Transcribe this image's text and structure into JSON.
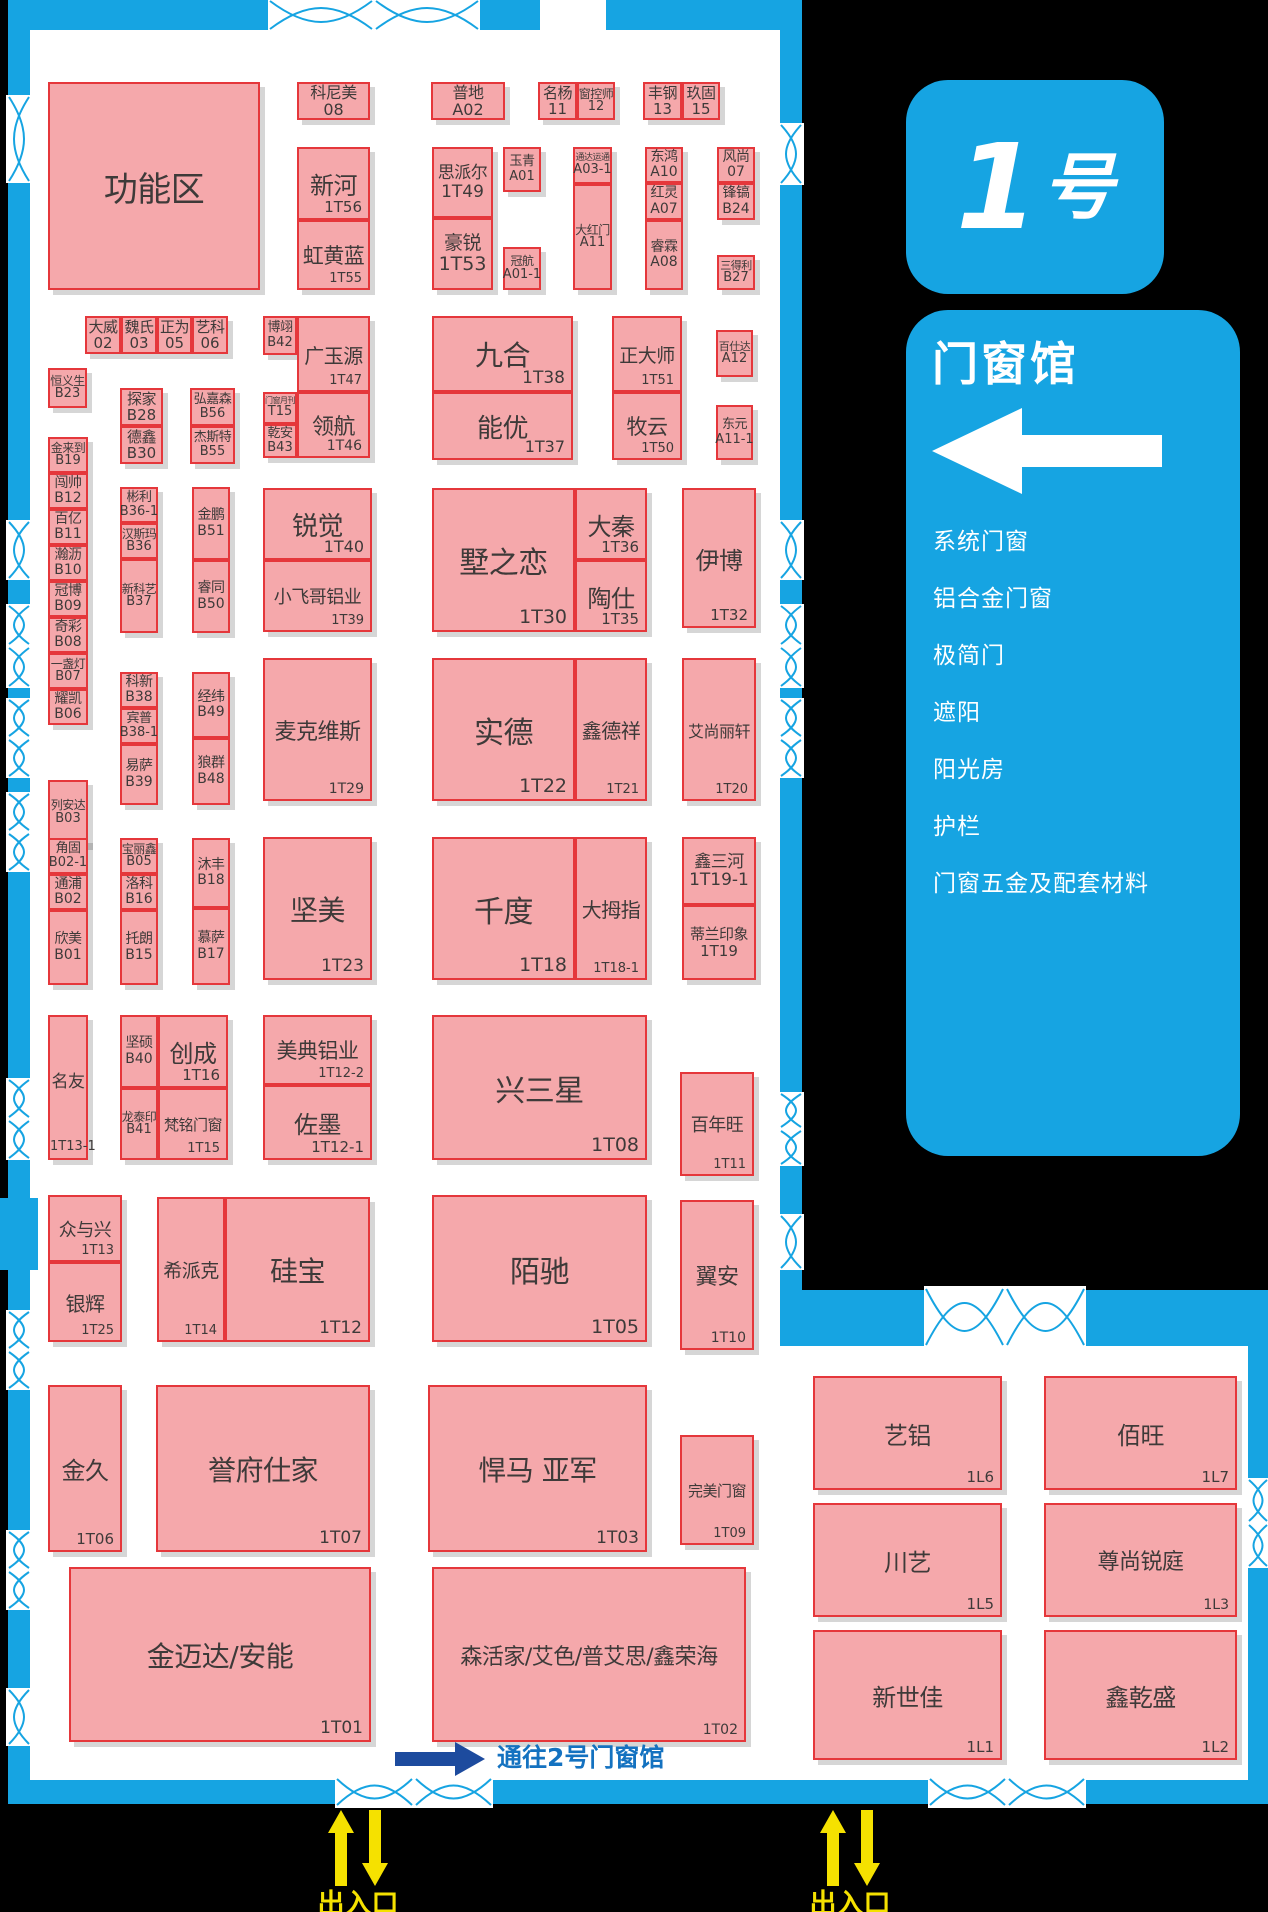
{
  "map": {
    "hall_badge_num": "1",
    "hall_badge_suffix": "号",
    "hall_name": "门窗馆",
    "categories": [
      "系统门窗",
      "铝合金门窗",
      "极简门",
      "遮阳",
      "阳光房",
      "护栏",
      "门窗五金及配套材料"
    ],
    "passage_note": "通往2号门窗馆",
    "entrance_label": "出入口",
    "colors": {
      "wall_blue": "#16A4E2",
      "booth_fill": "#F5A8AB",
      "booth_border": "#E5373B",
      "booth_text": "#3E3A39",
      "background_black": "#000000",
      "entrance_yellow": "#F5E100",
      "passage_navy": "#1D4B9E",
      "passage_text_blue": "#1472C0"
    }
  },
  "booths": [
    {
      "n": "功能区",
      "c": "",
      "x": 48,
      "y": 82,
      "w": 212,
      "h": 208,
      "fs": 34,
      "ly": "c"
    },
    {
      "n": "科尼美",
      "c": "08",
      "x": 297,
      "y": 82,
      "w": 73,
      "h": 38,
      "fs": 16,
      "ly": "s"
    },
    {
      "n": "普地",
      "c": "A02",
      "x": 431,
      "y": 82,
      "w": 74,
      "h": 38,
      "fs": 16,
      "ly": "s"
    },
    {
      "n": "名杨",
      "c": "11",
      "x": 538,
      "y": 82,
      "w": 39,
      "h": 38,
      "fs": 15,
      "ly": "s"
    },
    {
      "n": "窗控师",
      "c": "12",
      "x": 577,
      "y": 82,
      "w": 38,
      "h": 38,
      "fs": 12,
      "ly": "s"
    },
    {
      "n": "丰钢",
      "c": "13",
      "x": 643,
      "y": 82,
      "w": 39,
      "h": 38,
      "fs": 15,
      "ly": "s"
    },
    {
      "n": "玖固",
      "c": "15",
      "x": 682,
      "y": 82,
      "w": 38,
      "h": 38,
      "fs": 15,
      "ly": "s"
    },
    {
      "n": "新河",
      "c": "1T56",
      "x": 297,
      "y": 147,
      "w": 73,
      "h": 73,
      "fs": 24,
      "ly": "c"
    },
    {
      "n": "虹黄蓝",
      "c": "1T55",
      "x": 297,
      "y": 220,
      "w": 73,
      "h": 70,
      "fs": 21,
      "ly": "c"
    },
    {
      "n": "思派尔",
      "c": "1T49",
      "x": 432,
      "y": 147,
      "w": 61,
      "h": 71,
      "fs": 17,
      "ly": "s"
    },
    {
      "n": "豪锐",
      "c": "1T53",
      "x": 432,
      "y": 218,
      "w": 61,
      "h": 72,
      "fs": 19,
      "ly": "s"
    },
    {
      "n": "玉青",
      "c": "A01",
      "x": 503,
      "y": 147,
      "w": 38,
      "h": 45,
      "fs": 13,
      "ly": "s"
    },
    {
      "n": "冠航",
      "c": "A01-1",
      "x": 503,
      "y": 247,
      "w": 38,
      "h": 43,
      "fs": 12,
      "ly": "s"
    },
    {
      "n": "通达运通",
      "c": "A03-1",
      "x": 573,
      "y": 147,
      "w": 39,
      "h": 37,
      "fs": 9,
      "ly": "s"
    },
    {
      "n": "大红门",
      "c": "A11",
      "x": 573,
      "y": 184,
      "w": 39,
      "h": 106,
      "fs": 12,
      "ly": "s"
    },
    {
      "n": "东鸿",
      "c": "A10",
      "x": 645,
      "y": 147,
      "w": 38,
      "h": 36,
      "fs": 14,
      "ly": "s"
    },
    {
      "n": "红灵",
      "c": "A07",
      "x": 645,
      "y": 183,
      "w": 38,
      "h": 37,
      "fs": 14,
      "ly": "s"
    },
    {
      "n": "睿霖",
      "c": "A08",
      "x": 645,
      "y": 220,
      "w": 38,
      "h": 70,
      "fs": 14,
      "ly": "s"
    },
    {
      "n": "风尚",
      "c": "07",
      "x": 717,
      "y": 147,
      "w": 38,
      "h": 36,
      "fs": 14,
      "ly": "s"
    },
    {
      "n": "锋镐",
      "c": "B24",
      "x": 717,
      "y": 183,
      "w": 38,
      "h": 37,
      "fs": 14,
      "ly": "s"
    },
    {
      "n": "三得利",
      "c": "B27",
      "x": 717,
      "y": 255,
      "w": 38,
      "h": 35,
      "fs": 11,
      "ly": "s"
    },
    {
      "n": "大威",
      "c": "02",
      "x": 85,
      "y": 316,
      "w": 36,
      "h": 38,
      "fs": 15,
      "ly": "s"
    },
    {
      "n": "魏氏",
      "c": "03",
      "x": 121,
      "y": 316,
      "w": 36,
      "h": 38,
      "fs": 15,
      "ly": "s"
    },
    {
      "n": "正为",
      "c": "05",
      "x": 157,
      "y": 316,
      "w": 35,
      "h": 38,
      "fs": 15,
      "ly": "s"
    },
    {
      "n": "艺科",
      "c": "06",
      "x": 192,
      "y": 316,
      "w": 36,
      "h": 38,
      "fs": 15,
      "ly": "s"
    },
    {
      "n": "博翊",
      "c": "B42",
      "x": 263,
      "y": 316,
      "w": 34,
      "h": 39,
      "fs": 13,
      "ly": "s"
    },
    {
      "n": "广玉源",
      "c": "1T47",
      "x": 297,
      "y": 316,
      "w": 73,
      "h": 76,
      "fs": 20,
      "ly": "c"
    },
    {
      "n": "恒义生",
      "c": "B23",
      "x": 48,
      "y": 368,
      "w": 39,
      "h": 40,
      "fs": 12,
      "ly": "s"
    },
    {
      "n": "探家",
      "c": "B28",
      "x": 120,
      "y": 388,
      "w": 43,
      "h": 38,
      "fs": 15,
      "ly": "s"
    },
    {
      "n": "德鑫",
      "c": "B30",
      "x": 120,
      "y": 426,
      "w": 43,
      "h": 38,
      "fs": 15,
      "ly": "s"
    },
    {
      "n": "弘嘉森",
      "c": "B56",
      "x": 190,
      "y": 388,
      "w": 45,
      "h": 38,
      "fs": 13,
      "ly": "s"
    },
    {
      "n": "杰斯特",
      "c": "B55",
      "x": 190,
      "y": 426,
      "w": 45,
      "h": 38,
      "fs": 13,
      "ly": "s"
    },
    {
      "n": "门窗月刊",
      "c": "T15",
      "x": 263,
      "y": 392,
      "w": 34,
      "h": 32,
      "fs": 8,
      "ly": "s"
    },
    {
      "n": "乾安",
      "c": "B43",
      "x": 263,
      "y": 424,
      "w": 34,
      "h": 34,
      "fs": 13,
      "ly": "s"
    },
    {
      "n": "领航",
      "c": "1T46",
      "x": 297,
      "y": 392,
      "w": 73,
      "h": 66,
      "fs": 22,
      "ly": "c"
    },
    {
      "n": "九合",
      "c": "1T38",
      "x": 432,
      "y": 316,
      "w": 141,
      "h": 76,
      "fs": 28,
      "ly": "c"
    },
    {
      "n": "能优",
      "c": "1T37",
      "x": 432,
      "y": 392,
      "w": 141,
      "h": 68,
      "fs": 26,
      "ly": "c"
    },
    {
      "n": "正大师",
      "c": "1T51",
      "x": 612,
      "y": 316,
      "w": 70,
      "h": 76,
      "fs": 19,
      "ly": "c"
    },
    {
      "n": "牧云",
      "c": "1T50",
      "x": 612,
      "y": 392,
      "w": 70,
      "h": 68,
      "fs": 21,
      "ly": "c"
    },
    {
      "n": "百仕达",
      "c": "A12",
      "x": 716,
      "y": 330,
      "w": 37,
      "h": 47,
      "fs": 11,
      "ly": "s"
    },
    {
      "n": "东元",
      "c": "A11-1",
      "x": 716,
      "y": 405,
      "w": 37,
      "h": 55,
      "fs": 13,
      "ly": "s"
    },
    {
      "n": "金来到",
      "c": "B19",
      "x": 48,
      "y": 437,
      "w": 40,
      "h": 36,
      "fs": 12,
      "ly": "s"
    },
    {
      "n": "闯帅",
      "c": "B12",
      "x": 48,
      "y": 473,
      "w": 40,
      "h": 36,
      "fs": 14,
      "ly": "s"
    },
    {
      "n": "百亿",
      "c": "B11",
      "x": 48,
      "y": 509,
      "w": 40,
      "h": 36,
      "fs": 14,
      "ly": "s"
    },
    {
      "n": "瀚沥",
      "c": "B10",
      "x": 48,
      "y": 545,
      "w": 40,
      "h": 36,
      "fs": 14,
      "ly": "s"
    },
    {
      "n": "冠博",
      "c": "B09",
      "x": 48,
      "y": 581,
      "w": 40,
      "h": 36,
      "fs": 14,
      "ly": "s"
    },
    {
      "n": "奇彩",
      "c": "B08",
      "x": 48,
      "y": 617,
      "w": 40,
      "h": 36,
      "fs": 14,
      "ly": "s"
    },
    {
      "n": "一盏灯",
      "c": "B07",
      "x": 48,
      "y": 653,
      "w": 40,
      "h": 36,
      "fs": 12,
      "ly": "s"
    },
    {
      "n": "耀凯",
      "c": "B06",
      "x": 48,
      "y": 689,
      "w": 40,
      "h": 36,
      "fs": 14,
      "ly": "s"
    },
    {
      "n": "彬利",
      "c": "B36-1",
      "x": 120,
      "y": 487,
      "w": 38,
      "h": 36,
      "fs": 13,
      "ly": "s"
    },
    {
      "n": "汉斯玛",
      "c": "B36",
      "x": 120,
      "y": 523,
      "w": 38,
      "h": 36,
      "fs": 12,
      "ly": "s"
    },
    {
      "n": "新科艺",
      "c": "B37",
      "x": 120,
      "y": 559,
      "w": 38,
      "h": 74,
      "fs": 12,
      "ly": "s"
    },
    {
      "n": "金鹏",
      "c": "B51",
      "x": 192,
      "y": 487,
      "w": 38,
      "h": 73,
      "fs": 14,
      "ly": "s"
    },
    {
      "n": "睿同",
      "c": "B50",
      "x": 192,
      "y": 560,
      "w": 38,
      "h": 73,
      "fs": 14,
      "ly": "s"
    },
    {
      "n": "锐觉",
      "c": "1T40",
      "x": 263,
      "y": 488,
      "w": 109,
      "h": 72,
      "fs": 26,
      "ly": "c"
    },
    {
      "n": "小飞哥铝业",
      "c": "1T39",
      "x": 263,
      "y": 560,
      "w": 109,
      "h": 72,
      "fs": 18,
      "ly": "c"
    },
    {
      "n": "墅之恋",
      "c": "1T30",
      "x": 432,
      "y": 488,
      "w": 143,
      "h": 144,
      "fs": 30,
      "ly": "c"
    },
    {
      "n": "大秦",
      "c": "1T36",
      "x": 575,
      "y": 488,
      "w": 72,
      "h": 72,
      "fs": 24,
      "ly": "c"
    },
    {
      "n": "陶仕",
      "c": "1T35",
      "x": 575,
      "y": 560,
      "w": 72,
      "h": 72,
      "fs": 24,
      "ly": "c"
    },
    {
      "n": "伊博",
      "c": "1T32",
      "x": 682,
      "y": 488,
      "w": 74,
      "h": 140,
      "fs": 24,
      "ly": "c"
    },
    {
      "n": "科新",
      "c": "B38",
      "x": 120,
      "y": 672,
      "w": 38,
      "h": 36,
      "fs": 14,
      "ly": "s"
    },
    {
      "n": "宾普",
      "c": "B38-1",
      "x": 120,
      "y": 708,
      "w": 38,
      "h": 36,
      "fs": 13,
      "ly": "s"
    },
    {
      "n": "易萨",
      "c": "B39",
      "x": 120,
      "y": 744,
      "w": 38,
      "h": 61,
      "fs": 14,
      "ly": "s"
    },
    {
      "n": "经纬",
      "c": "B49",
      "x": 192,
      "y": 672,
      "w": 38,
      "h": 66,
      "fs": 14,
      "ly": "s"
    },
    {
      "n": "狼群",
      "c": "B48",
      "x": 192,
      "y": 738,
      "w": 38,
      "h": 67,
      "fs": 14,
      "ly": "s"
    },
    {
      "n": "麦克维斯",
      "c": "1T29",
      "x": 263,
      "y": 658,
      "w": 109,
      "h": 143,
      "fs": 22,
      "ly": "c"
    },
    {
      "n": "实德",
      "c": "1T22",
      "x": 432,
      "y": 658,
      "w": 143,
      "h": 143,
      "fs": 30,
      "ly": "c"
    },
    {
      "n": "鑫德祥",
      "c": "1T21",
      "x": 575,
      "y": 658,
      "w": 72,
      "h": 143,
      "fs": 20,
      "ly": "c"
    },
    {
      "n": "艾尚丽轩",
      "c": "1T20",
      "x": 682,
      "y": 658,
      "w": 74,
      "h": 143,
      "fs": 16,
      "ly": "c"
    },
    {
      "n": "列安达",
      "c": "B03",
      "x": 48,
      "y": 780,
      "w": 40,
      "h": 65,
      "fs": 12,
      "ly": "s"
    },
    {
      "n": "角固",
      "c": "B02-1",
      "x": 48,
      "y": 838,
      "w": 40,
      "h": 36,
      "fs": 13,
      "ly": "s"
    },
    {
      "n": "通浦",
      "c": "B02",
      "x": 48,
      "y": 874,
      "w": 40,
      "h": 36,
      "fs": 14,
      "ly": "s"
    },
    {
      "n": "欣美",
      "c": "B01",
      "x": 48,
      "y": 910,
      "w": 40,
      "h": 75,
      "fs": 14,
      "ly": "s"
    },
    {
      "n": "宝丽鑫",
      "c": "B05",
      "x": 120,
      "y": 838,
      "w": 38,
      "h": 36,
      "fs": 12,
      "ly": "s"
    },
    {
      "n": "洛科",
      "c": "B16",
      "x": 120,
      "y": 874,
      "w": 38,
      "h": 36,
      "fs": 14,
      "ly": "s"
    },
    {
      "n": "托朗",
      "c": "B15",
      "x": 120,
      "y": 910,
      "w": 38,
      "h": 75,
      "fs": 14,
      "ly": "s"
    },
    {
      "n": "沐丰",
      "c": "B18",
      "x": 192,
      "y": 838,
      "w": 38,
      "h": 70,
      "fs": 14,
      "ly": "s"
    },
    {
      "n": "慕萨",
      "c": "B17",
      "x": 192,
      "y": 908,
      "w": 38,
      "h": 77,
      "fs": 14,
      "ly": "s"
    },
    {
      "n": "坚美",
      "c": "1T23",
      "x": 263,
      "y": 837,
      "w": 109,
      "h": 143,
      "fs": 28,
      "ly": "c"
    },
    {
      "n": "千度",
      "c": "1T18",
      "x": 432,
      "y": 837,
      "w": 143,
      "h": 143,
      "fs": 30,
      "ly": "c"
    },
    {
      "n": "大拇指",
      "c": "1T18-1",
      "x": 575,
      "y": 837,
      "w": 72,
      "h": 143,
      "fs": 20,
      "ly": "c"
    },
    {
      "n": "鑫三河",
      "c": "1T19-1",
      "x": 682,
      "y": 837,
      "w": 74,
      "h": 68,
      "fs": 17,
      "ly": "s"
    },
    {
      "n": "蒂兰印象",
      "c": "1T19",
      "x": 682,
      "y": 905,
      "w": 74,
      "h": 75,
      "fs": 15,
      "ly": "s"
    },
    {
      "n": "名友",
      "c": "1T13-1",
      "x": 48,
      "y": 1015,
      "w": 40,
      "h": 145,
      "fs": 17,
      "ly": "cc"
    },
    {
      "n": "坚硕",
      "c": "B40",
      "x": 120,
      "y": 1015,
      "w": 38,
      "h": 73,
      "fs": 14,
      "ly": "s"
    },
    {
      "n": "创成",
      "c": "1T16",
      "x": 158,
      "y": 1015,
      "w": 70,
      "h": 73,
      "fs": 24,
      "ly": "c"
    },
    {
      "n": "龙泰印",
      "c": "B41",
      "x": 120,
      "y": 1088,
      "w": 38,
      "h": 72,
      "fs": 12,
      "ly": "s"
    },
    {
      "n": "梵铭门窗",
      "c": "1T15",
      "x": 158,
      "y": 1088,
      "w": 70,
      "h": 72,
      "fs": 15,
      "ly": "c"
    },
    {
      "n": "美典铝业",
      "c": "1T12-2",
      "x": 263,
      "y": 1015,
      "w": 109,
      "h": 70,
      "fs": 21,
      "ly": "c"
    },
    {
      "n": "佐墨",
      "c": "1T12-1",
      "x": 263,
      "y": 1085,
      "w": 109,
      "h": 75,
      "fs": 24,
      "ly": "c"
    },
    {
      "n": "兴三星",
      "c": "1T08",
      "x": 432,
      "y": 1015,
      "w": 215,
      "h": 145,
      "fs": 30,
      "ly": "c"
    },
    {
      "n": "百年旺",
      "c": "1T11",
      "x": 680,
      "y": 1072,
      "w": 74,
      "h": 104,
      "fs": 18,
      "ly": "c"
    },
    {
      "n": "众与兴",
      "c": "1T13",
      "x": 48,
      "y": 1195,
      "w": 74,
      "h": 67,
      "fs": 18,
      "ly": "c"
    },
    {
      "n": "银辉",
      "c": "1T25",
      "x": 48,
      "y": 1262,
      "w": 74,
      "h": 80,
      "fs": 20,
      "ly": "c"
    },
    {
      "n": "希派克",
      "c": "1T14",
      "x": 157,
      "y": 1197,
      "w": 68,
      "h": 145,
      "fs": 19,
      "ly": "c"
    },
    {
      "n": "硅宝",
      "c": "1T12",
      "x": 225,
      "y": 1197,
      "w": 145,
      "h": 145,
      "fs": 28,
      "ly": "c"
    },
    {
      "n": "陌驰",
      "c": "1T05",
      "x": 432,
      "y": 1195,
      "w": 215,
      "h": 147,
      "fs": 30,
      "ly": "c"
    },
    {
      "n": "翼安",
      "c": "1T10",
      "x": 680,
      "y": 1200,
      "w": 74,
      "h": 150,
      "fs": 22,
      "ly": "c"
    },
    {
      "n": "金久",
      "c": "1T06",
      "x": 48,
      "y": 1385,
      "w": 74,
      "h": 167,
      "fs": 24,
      "ly": "c"
    },
    {
      "n": "誉府仕家",
      "c": "1T07",
      "x": 156,
      "y": 1385,
      "w": 214,
      "h": 167,
      "fs": 28,
      "ly": "c"
    },
    {
      "n": "悍马 亚军",
      "c": "1T03",
      "x": 428,
      "y": 1385,
      "w": 219,
      "h": 167,
      "fs": 28,
      "ly": "c"
    },
    {
      "n": "完美门窗",
      "c": "1T09",
      "x": 680,
      "y": 1435,
      "w": 74,
      "h": 110,
      "fs": 15,
      "ly": "c"
    },
    {
      "n": "金迈达/安能",
      "c": "1T01",
      "x": 69,
      "y": 1567,
      "w": 302,
      "h": 175,
      "fs": 28,
      "ly": "c"
    },
    {
      "n": "森活家/艾色/普艾思/鑫荣海",
      "c": "1T02",
      "x": 432,
      "y": 1567,
      "w": 314,
      "h": 175,
      "fs": 22,
      "ly": "c"
    },
    {
      "n": "艺铝",
      "c": "1L6",
      "x": 813,
      "y": 1376,
      "w": 189,
      "h": 114,
      "fs": 24,
      "ly": "c"
    },
    {
      "n": "佰旺",
      "c": "1L7",
      "x": 1044,
      "y": 1376,
      "w": 193,
      "h": 114,
      "fs": 24,
      "ly": "c"
    },
    {
      "n": "川艺",
      "c": "1L5",
      "x": 813,
      "y": 1503,
      "w": 189,
      "h": 114,
      "fs": 24,
      "ly": "c"
    },
    {
      "n": "尊尚锐庭",
      "c": "1L3",
      "x": 1044,
      "y": 1503,
      "w": 193,
      "h": 114,
      "fs": 22,
      "ly": "c"
    },
    {
      "n": "新世佳",
      "c": "1L1",
      "x": 813,
      "y": 1630,
      "w": 189,
      "h": 130,
      "fs": 24,
      "ly": "c"
    },
    {
      "n": "鑫乾盛",
      "c": "1L2",
      "x": 1044,
      "y": 1630,
      "w": 193,
      "h": 130,
      "fs": 24,
      "ly": "c"
    }
  ]
}
